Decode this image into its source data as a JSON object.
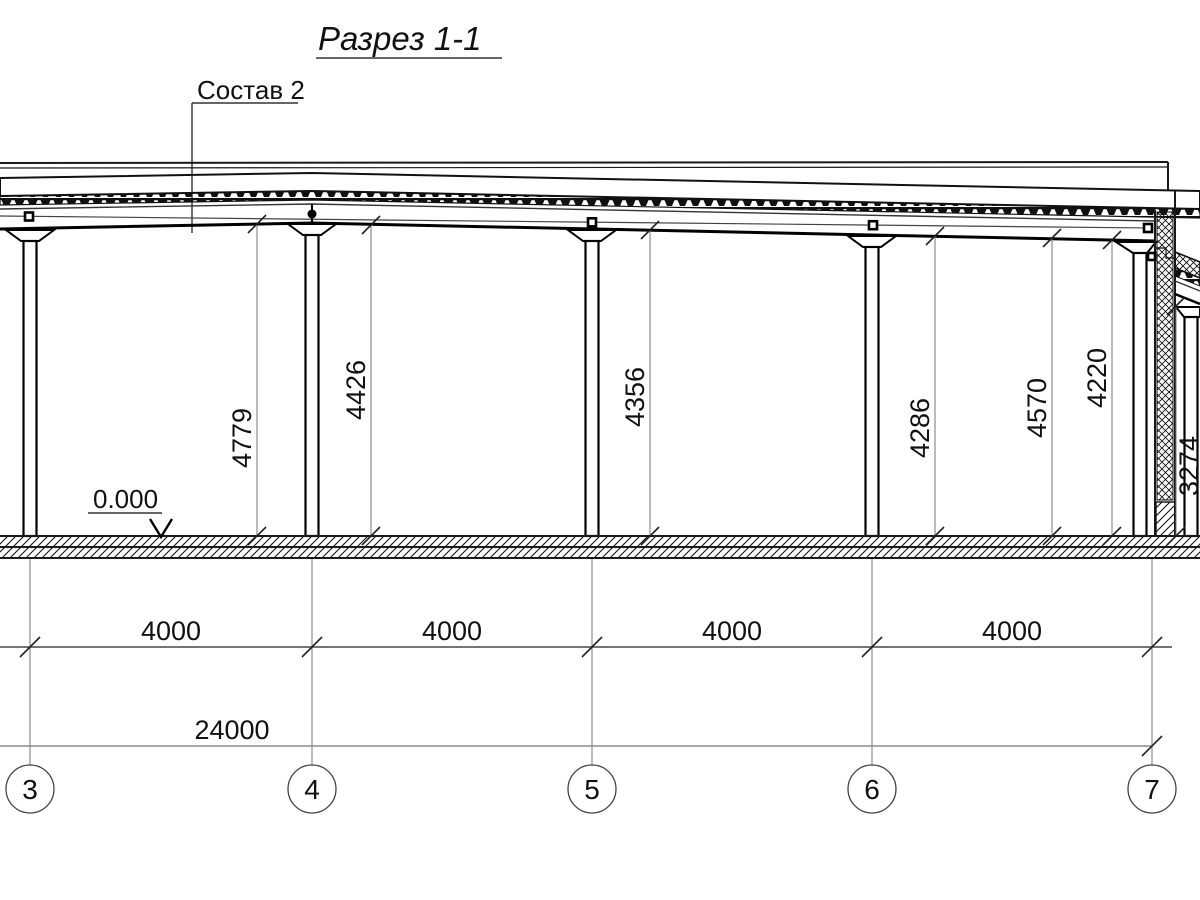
{
  "drawing": {
    "title": "Разрез 1-1",
    "callout_label": "Состав 2",
    "elevation_mark": "0.000",
    "clear_heights": [
      "4779",
      "4426",
      "4356",
      "4286",
      "4570",
      "4220",
      "3274"
    ],
    "bay_dimensions": [
      "4000",
      "4000",
      "4000",
      "4000"
    ],
    "overall_dimension": "24000",
    "grid_axes": [
      "3",
      "4",
      "5",
      "6",
      "7"
    ],
    "colors": {
      "line": "#1a1a1a",
      "dim_line": "#777777",
      "background": "#ffffff"
    }
  }
}
